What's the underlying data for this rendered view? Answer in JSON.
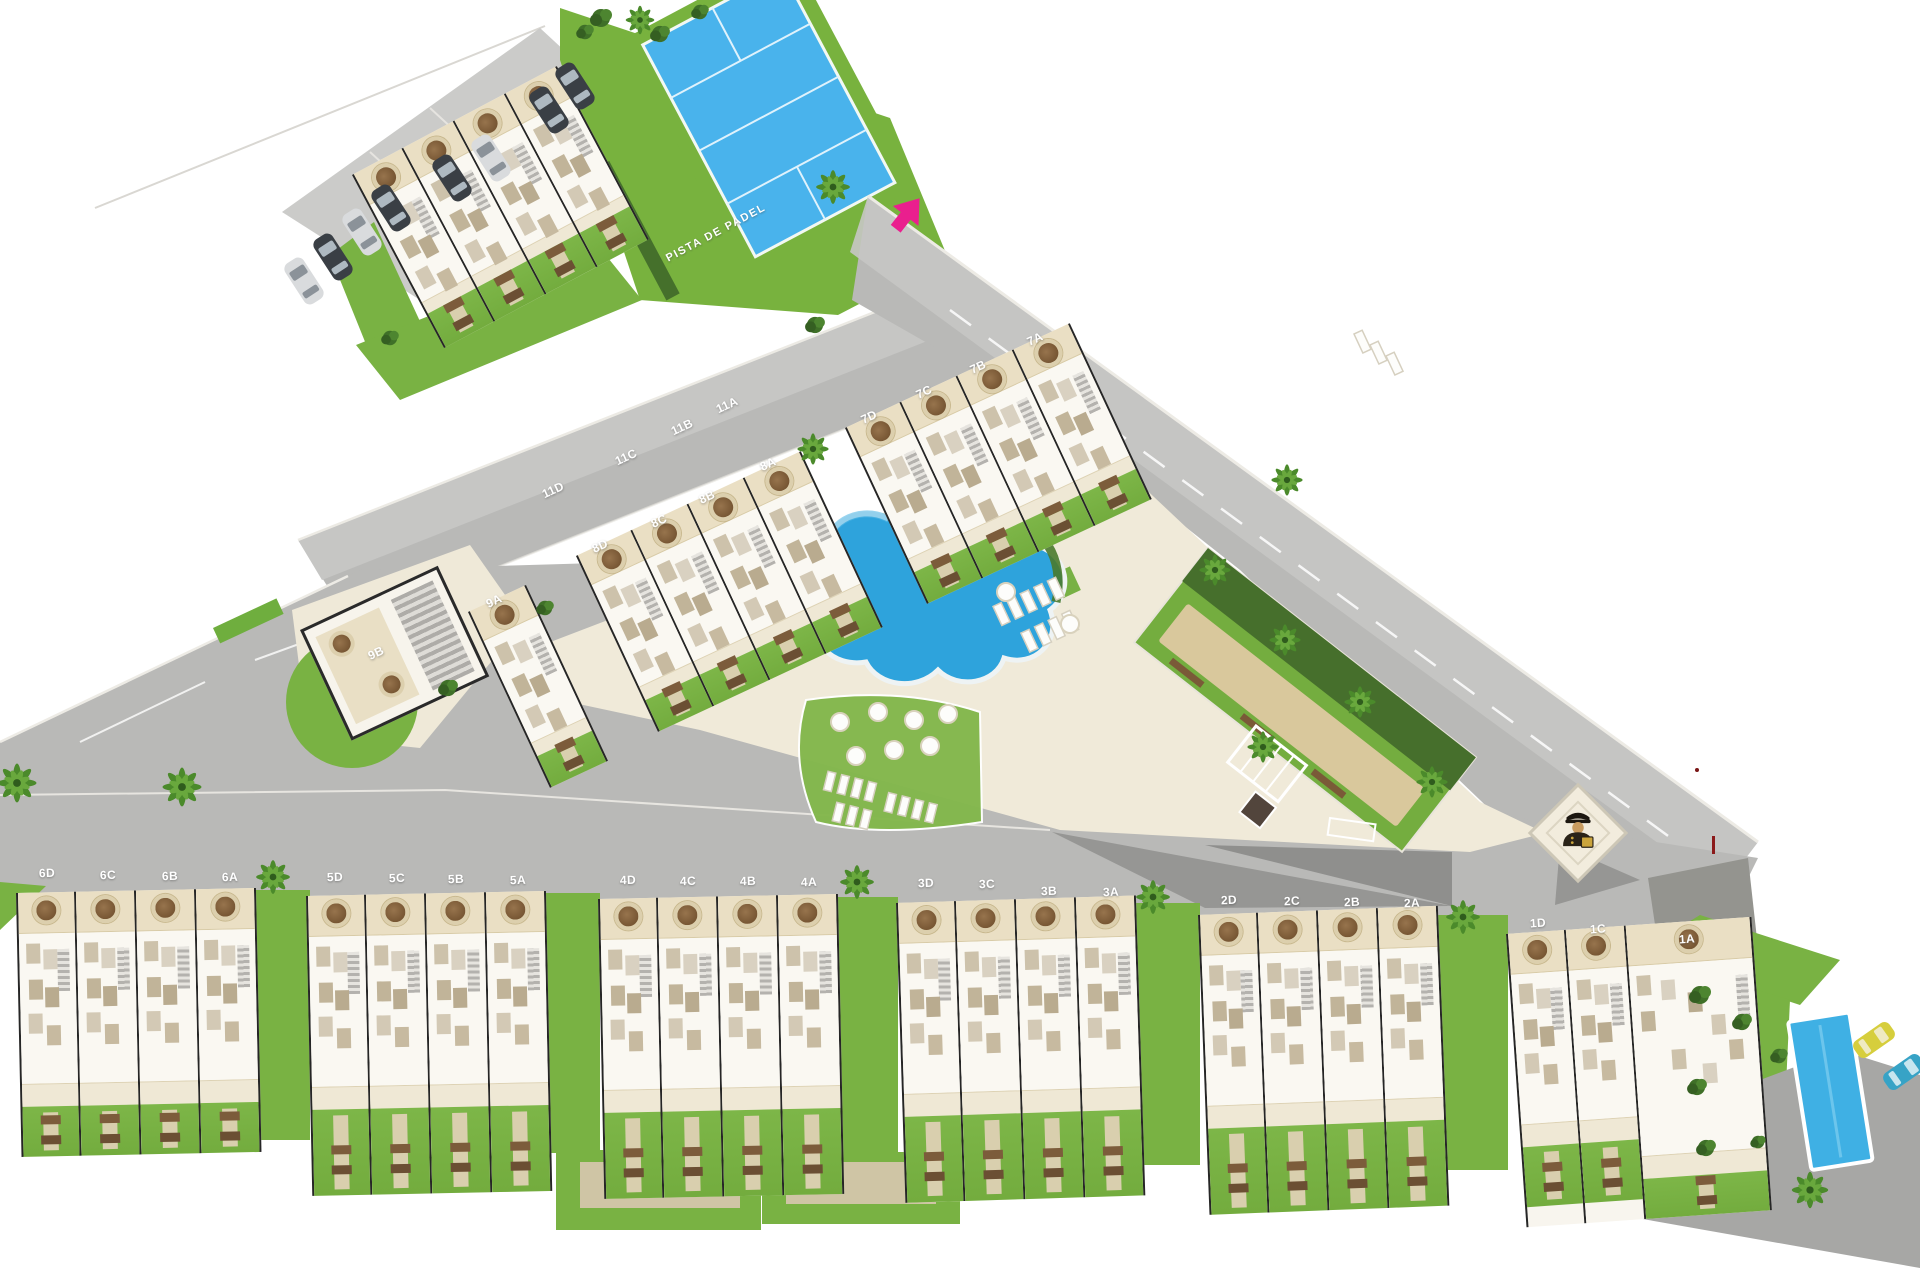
{
  "site_plan": {
    "padel_court": {
      "label": "PISTA DE PADEL"
    },
    "unit_labels": [
      {
        "id": "11A",
        "x": 727,
        "y": 405,
        "r": -25
      },
      {
        "id": "11B",
        "x": 682,
        "y": 427,
        "r": -25
      },
      {
        "id": "11C",
        "x": 626,
        "y": 457,
        "r": -25
      },
      {
        "id": "11D",
        "x": 553,
        "y": 490,
        "r": -25
      },
      {
        "id": "7A",
        "x": 1035,
        "y": 339,
        "r": -25
      },
      {
        "id": "7B",
        "x": 978,
        "y": 367,
        "r": -25
      },
      {
        "id": "7C",
        "x": 924,
        "y": 392,
        "r": -25
      },
      {
        "id": "7D",
        "x": 869,
        "y": 417,
        "r": -25
      },
      {
        "id": "8A",
        "x": 768,
        "y": 464,
        "r": -25
      },
      {
        "id": "8B",
        "x": 707,
        "y": 497,
        "r": -25
      },
      {
        "id": "8C",
        "x": 659,
        "y": 521,
        "r": -25
      },
      {
        "id": "8D",
        "x": 600,
        "y": 546,
        "r": -25
      },
      {
        "id": "9A",
        "x": 494,
        "y": 601,
        "r": -25
      },
      {
        "id": "9B",
        "x": 376,
        "y": 653,
        "r": -25
      },
      {
        "id": "6D",
        "x": 47,
        "y": 873,
        "r": -1.5
      },
      {
        "id": "6C",
        "x": 108,
        "y": 875,
        "r": -1.5
      },
      {
        "id": "6B",
        "x": 170,
        "y": 876,
        "r": -1.5
      },
      {
        "id": "6A",
        "x": 230,
        "y": 877,
        "r": -1.5
      },
      {
        "id": "5D",
        "x": 335,
        "y": 877,
        "r": -1.5
      },
      {
        "id": "5C",
        "x": 397,
        "y": 878,
        "r": -1.5
      },
      {
        "id": "5B",
        "x": 456,
        "y": 879,
        "r": -1.5
      },
      {
        "id": "5A",
        "x": 518,
        "y": 880,
        "r": -1.5
      },
      {
        "id": "4D",
        "x": 628,
        "y": 880,
        "r": -1.5
      },
      {
        "id": "4C",
        "x": 688,
        "y": 881,
        "r": -1.5
      },
      {
        "id": "4B",
        "x": 748,
        "y": 881,
        "r": -1.5
      },
      {
        "id": "4A",
        "x": 809,
        "y": 882,
        "r": -1.5
      },
      {
        "id": "3D",
        "x": 926,
        "y": 883,
        "r": -2
      },
      {
        "id": "3C",
        "x": 987,
        "y": 884,
        "r": -2
      },
      {
        "id": "3B",
        "x": 1049,
        "y": 891,
        "r": -2
      },
      {
        "id": "3A",
        "x": 1111,
        "y": 892,
        "r": -2
      },
      {
        "id": "2D",
        "x": 1229,
        "y": 900,
        "r": -2.5
      },
      {
        "id": "2C",
        "x": 1292,
        "y": 901,
        "r": -2.5
      },
      {
        "id": "2B",
        "x": 1352,
        "y": 902,
        "r": -2.5
      },
      {
        "id": "2A",
        "x": 1412,
        "y": 903,
        "r": -2.5
      },
      {
        "id": "1D",
        "x": 1538,
        "y": 923,
        "r": -4
      },
      {
        "id": "1C",
        "x": 1598,
        "y": 929,
        "r": -4
      },
      {
        "id": "1A",
        "x": 1687,
        "y": 939,
        "r": -4
      }
    ],
    "icons": {
      "entrance_arrow": "entrance-arrow-icon",
      "security_guard": "security-guard-icon",
      "palm_tree": "palm-tree-icon"
    },
    "colors": {
      "road": "#b9b9b7",
      "road_light": "#c7c7c5",
      "road_dark_wedge": "#969694",
      "grass": "#79b243",
      "hedge": "#46702c",
      "deck_cream": "#f0ead9",
      "terrace_beige": "#eadfc4",
      "pool_blue": "#2ea3dc",
      "padel_blue": "#49b3ec",
      "sand": "#d9c89c",
      "entrance_pink": "#ea1f8e",
      "wall_dark": "#262626"
    }
  }
}
